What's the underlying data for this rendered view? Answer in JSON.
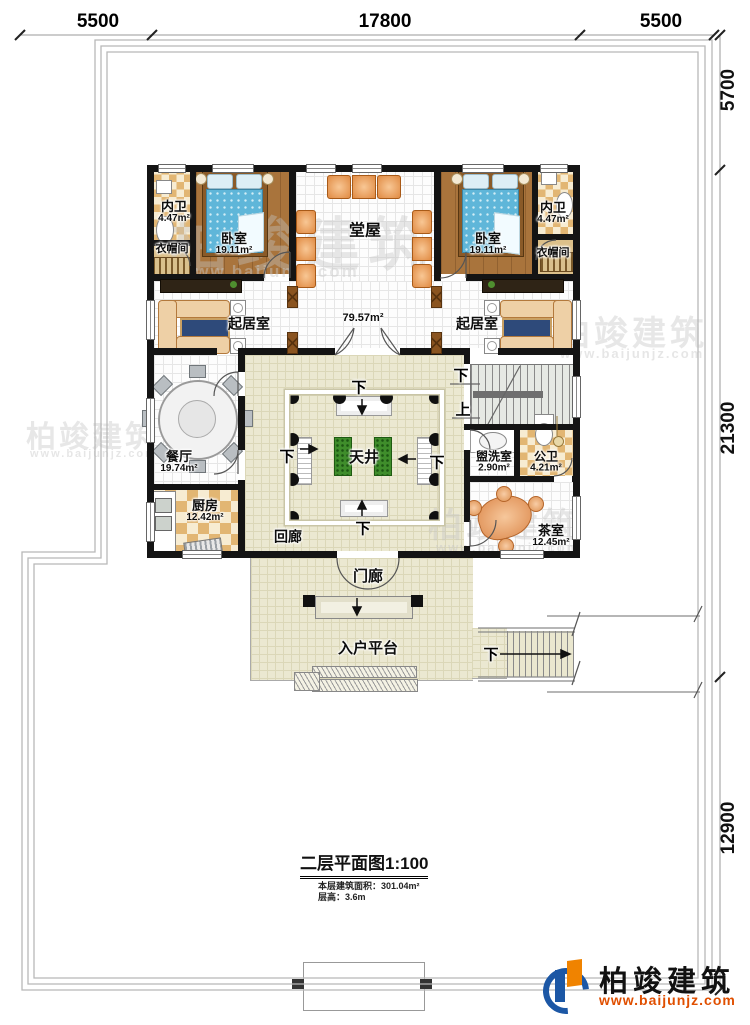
{
  "dimensions": {
    "top": [
      "5500",
      "17800",
      "5500"
    ],
    "right": [
      "5700",
      "21300",
      "12900"
    ]
  },
  "rooms": {
    "neiwei_left": {
      "name": "内卫",
      "area": "4.47m²"
    },
    "bedroom_left": {
      "name": "卧室",
      "area": "19.11m²"
    },
    "closet_left": {
      "name": "衣帽间"
    },
    "tangwu": {
      "name": "堂屋"
    },
    "bedroom_right": {
      "name": "卧室",
      "area": "19.11m²"
    },
    "neiwei_right": {
      "name": "内卫",
      "area": "4.47m²"
    },
    "closet_right": {
      "name": "衣帽间"
    },
    "living_left": {
      "name": "起居室"
    },
    "living_right": {
      "name": "起居室"
    },
    "band_area": "79.57m²",
    "dining": {
      "name": "餐厅",
      "area": "19.74m²"
    },
    "kitchen": {
      "name": "厨房",
      "area": "12.42m²"
    },
    "tianjing": {
      "name": "天井"
    },
    "huilang": {
      "name": "回廊"
    },
    "washroom": {
      "name": "盥洗室",
      "area": "2.90m²"
    },
    "gongwei": {
      "name": "公卫",
      "area": "4.21m²"
    },
    "tearoom": {
      "name": "茶室",
      "area": "12.45m²"
    },
    "porch": {
      "name": "门廊"
    },
    "platform": {
      "name": "入户平台"
    }
  },
  "markers": {
    "down": "下",
    "up": "上"
  },
  "titleblock": {
    "title": "二层平面图1:100",
    "area_line": "本层建筑面积：301.04m²",
    "height_line": "层高：3.6m"
  },
  "logo": {
    "name": "柏竣建筑",
    "url": "www.baijunjz.com"
  },
  "colors": {
    "accent_blue": "#1c57a5",
    "accent_orange": "#f08300",
    "url_red": "#e04f00"
  }
}
